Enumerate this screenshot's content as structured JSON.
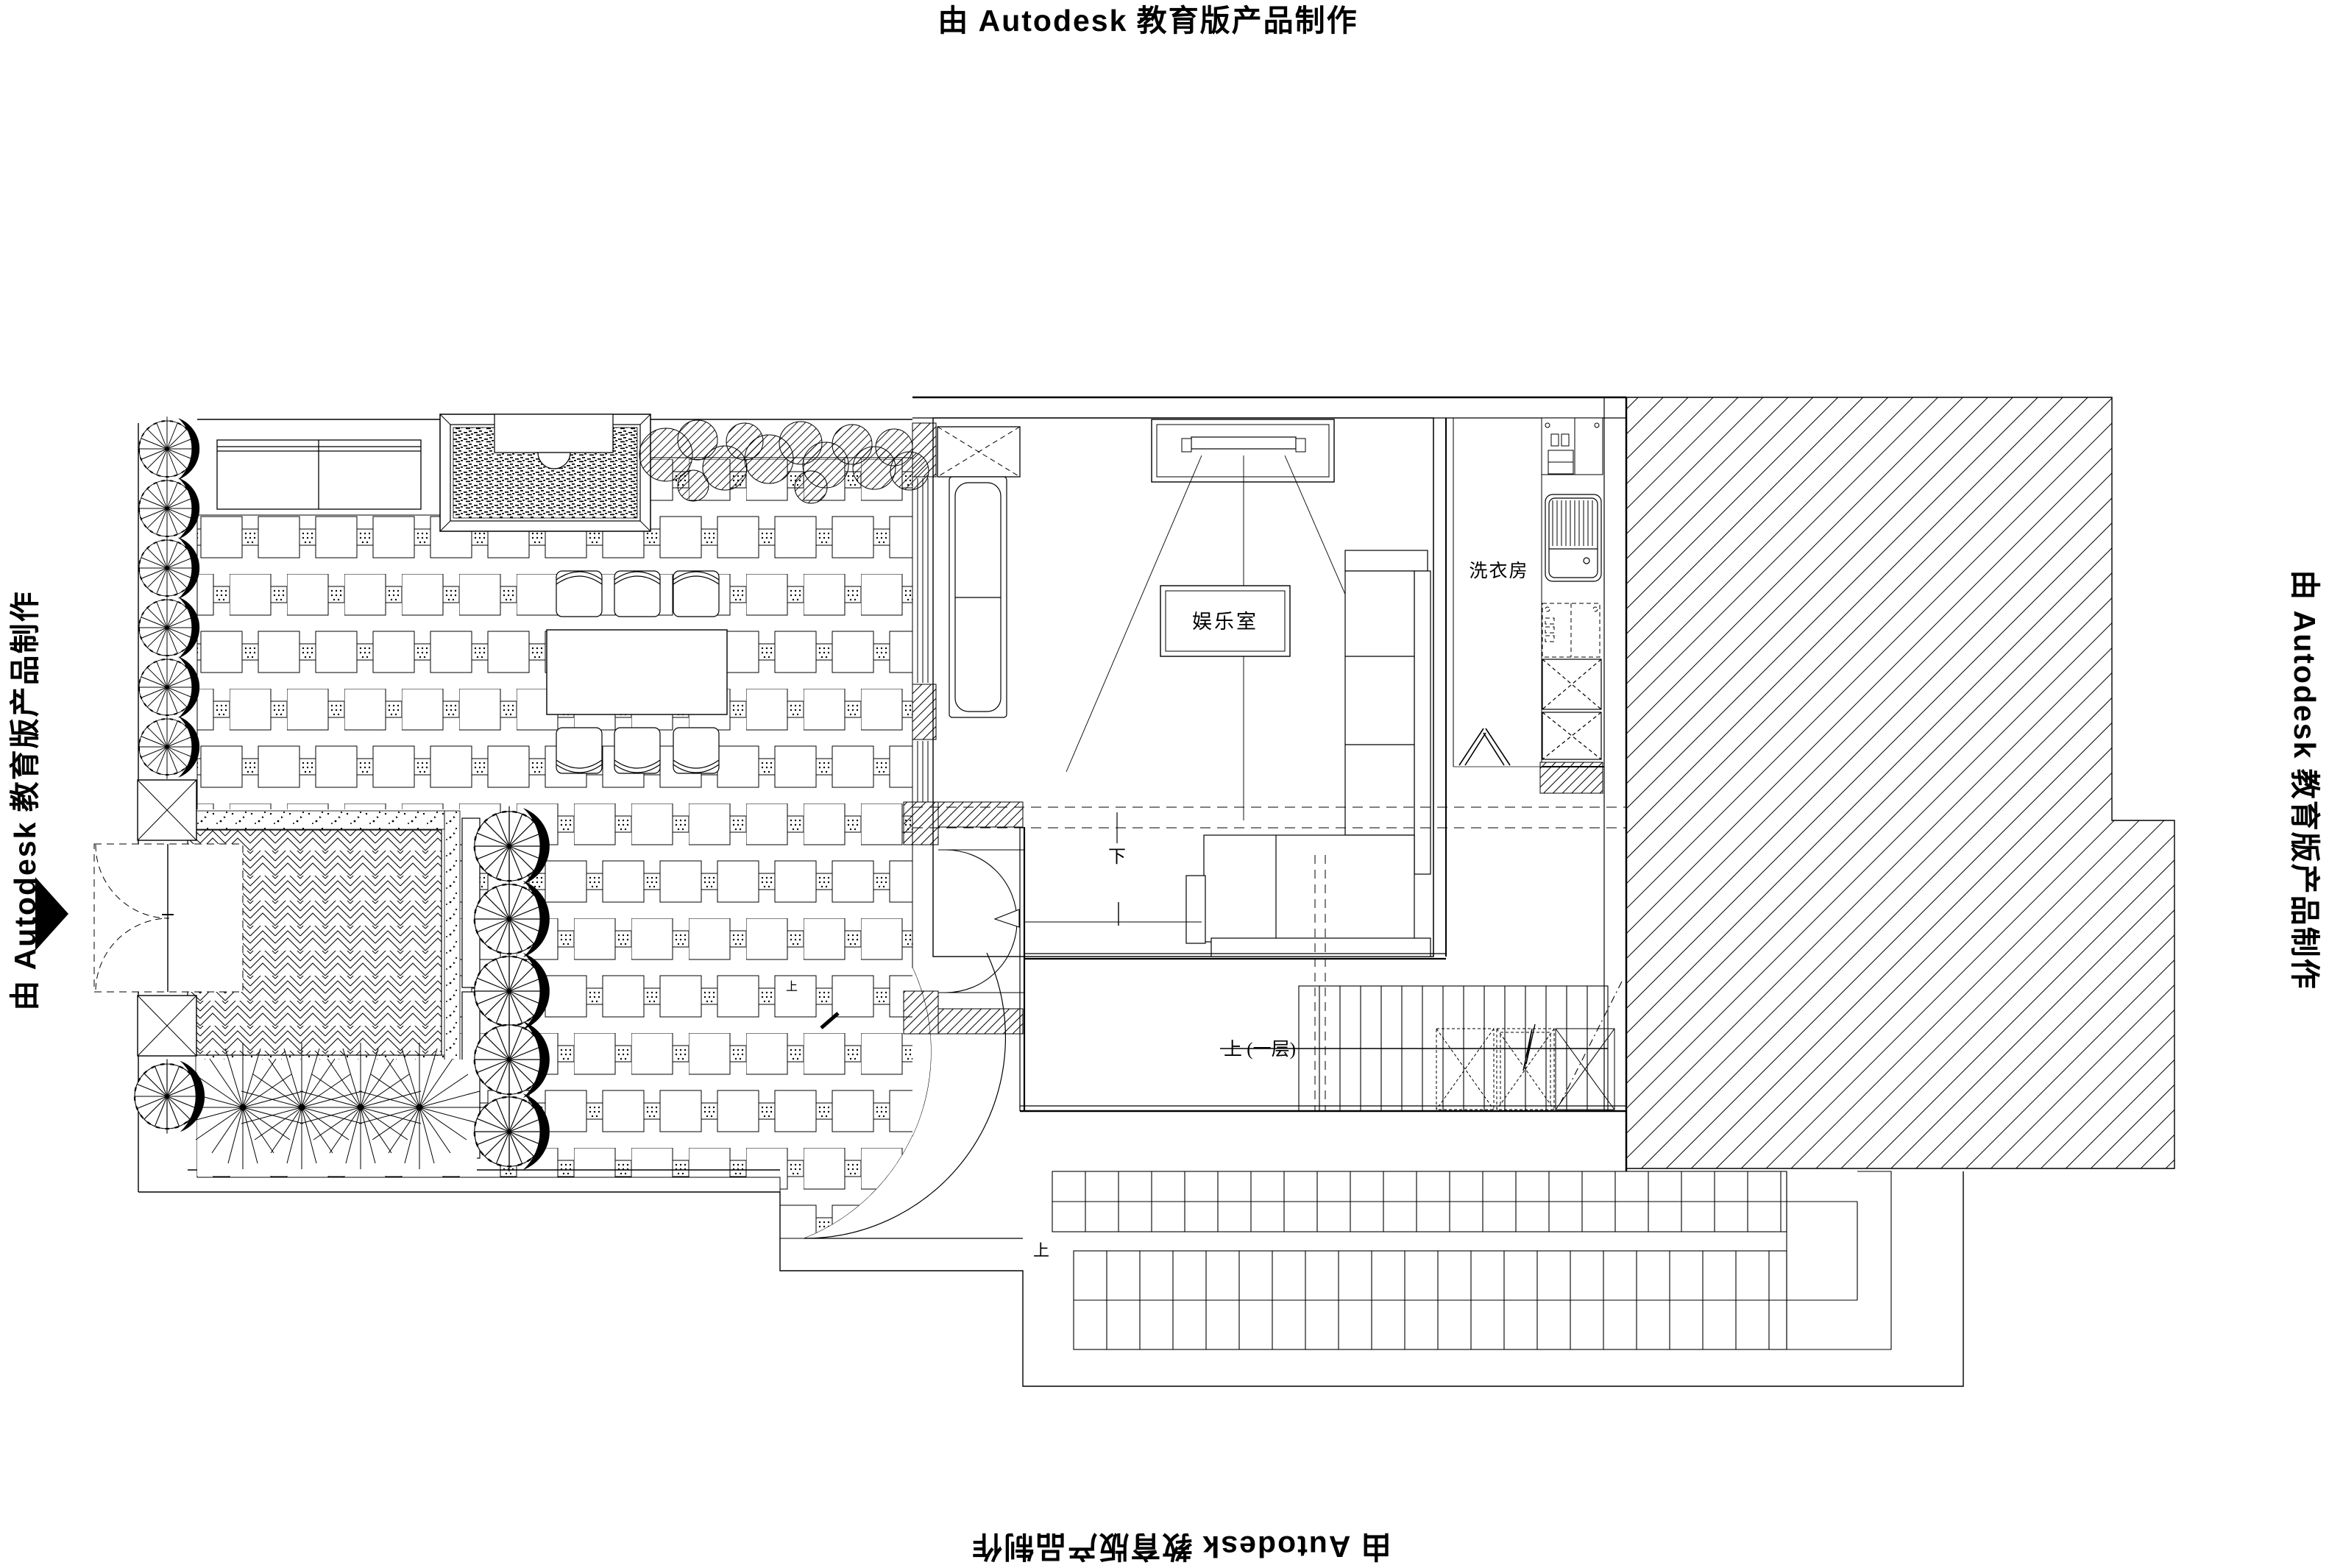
{
  "watermark": {
    "prefix": "由",
    "brand": "Autodesk",
    "suffix": "教育版产品制作"
  },
  "labels": {
    "entertainment_room": "娱乐室",
    "laundry_room": "洗衣房",
    "stair_up_first_floor": "上 (一层)",
    "stair_down": "下",
    "terrace_steps_up": "上",
    "garden_steps_up": "上"
  },
  "colors": {
    "line": "#000000",
    "background": "#ffffff"
  },
  "drawing": {
    "type": "floor-plan",
    "produced_by_note": "由 Autodesk 教育版产品制作"
  }
}
